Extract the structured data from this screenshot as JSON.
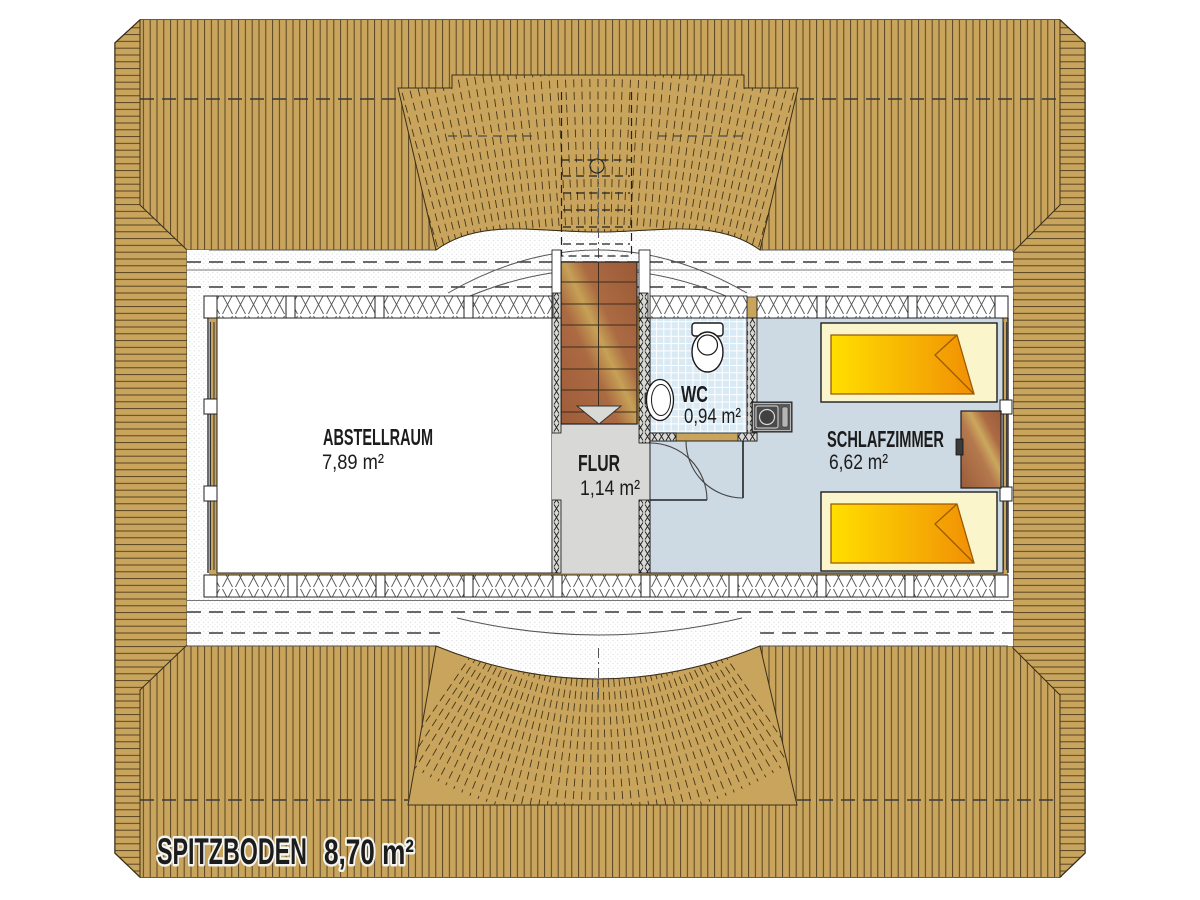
{
  "plan": {
    "title": "SPITZBODEN",
    "title_area": "8,70 m²"
  },
  "rooms": {
    "abstellraum": {
      "label": "ABSTELLRAUM",
      "area": "7,89 m²"
    },
    "flur": {
      "label": "FLUR",
      "area": "1,14 m²"
    },
    "wc": {
      "label": "WC",
      "area": "0,94 m²"
    },
    "schlafzimmer": {
      "label": "SCHLAFZIMMER",
      "area": "6,62 m²"
    }
  },
  "colors": {
    "roof_tan": "#c9a45c",
    "roof_line": "#4a3a1e",
    "bedroom_floor": "#cdd9e3",
    "wc_tile": "#d9eaf4",
    "flur_floor": "#d8d8d6",
    "abstellraum_floor": "#ffffff",
    "bed_frame": "#fbf5cc",
    "blanket_yellow": "#ffdf00",
    "blanket_orange": "#f18f05",
    "stair_wood_dark": "#a05c38",
    "stair_wood_light": "#c8a355",
    "appliance_gray": "#585858"
  }
}
